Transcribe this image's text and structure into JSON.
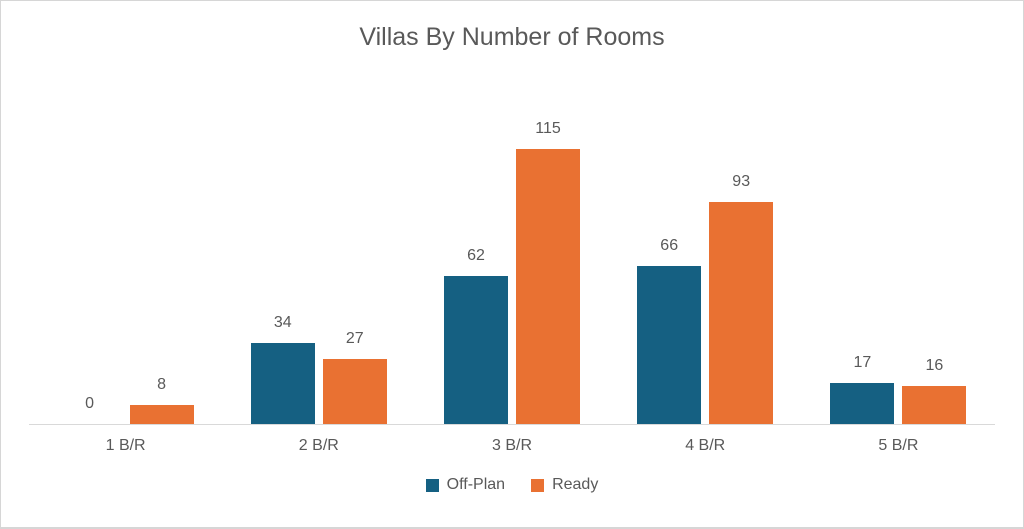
{
  "chart_data": {
    "type": "bar",
    "title": "Villas By Number of Rooms",
    "categories": [
      "1 B/R",
      "2 B/R",
      "3 B/R",
      "4 B/R",
      "5 B/R"
    ],
    "series": [
      {
        "name": "Off-Plan",
        "color": "#156082",
        "values": [
          0,
          34,
          62,
          66,
          17
        ]
      },
      {
        "name": "Ready",
        "color": "#E97132",
        "values": [
          8,
          27,
          115,
          93,
          16
        ]
      }
    ],
    "data_labels": true,
    "legend_position": "bottom",
    "grid": false,
    "xlabel": "",
    "ylabel": "",
    "ylim": [
      0,
      120
    ],
    "text_color": "#595959",
    "axis_line_color": "#D9D9D9",
    "background_color": "#FFFFFF",
    "border_color": "#D6D6D6"
  }
}
